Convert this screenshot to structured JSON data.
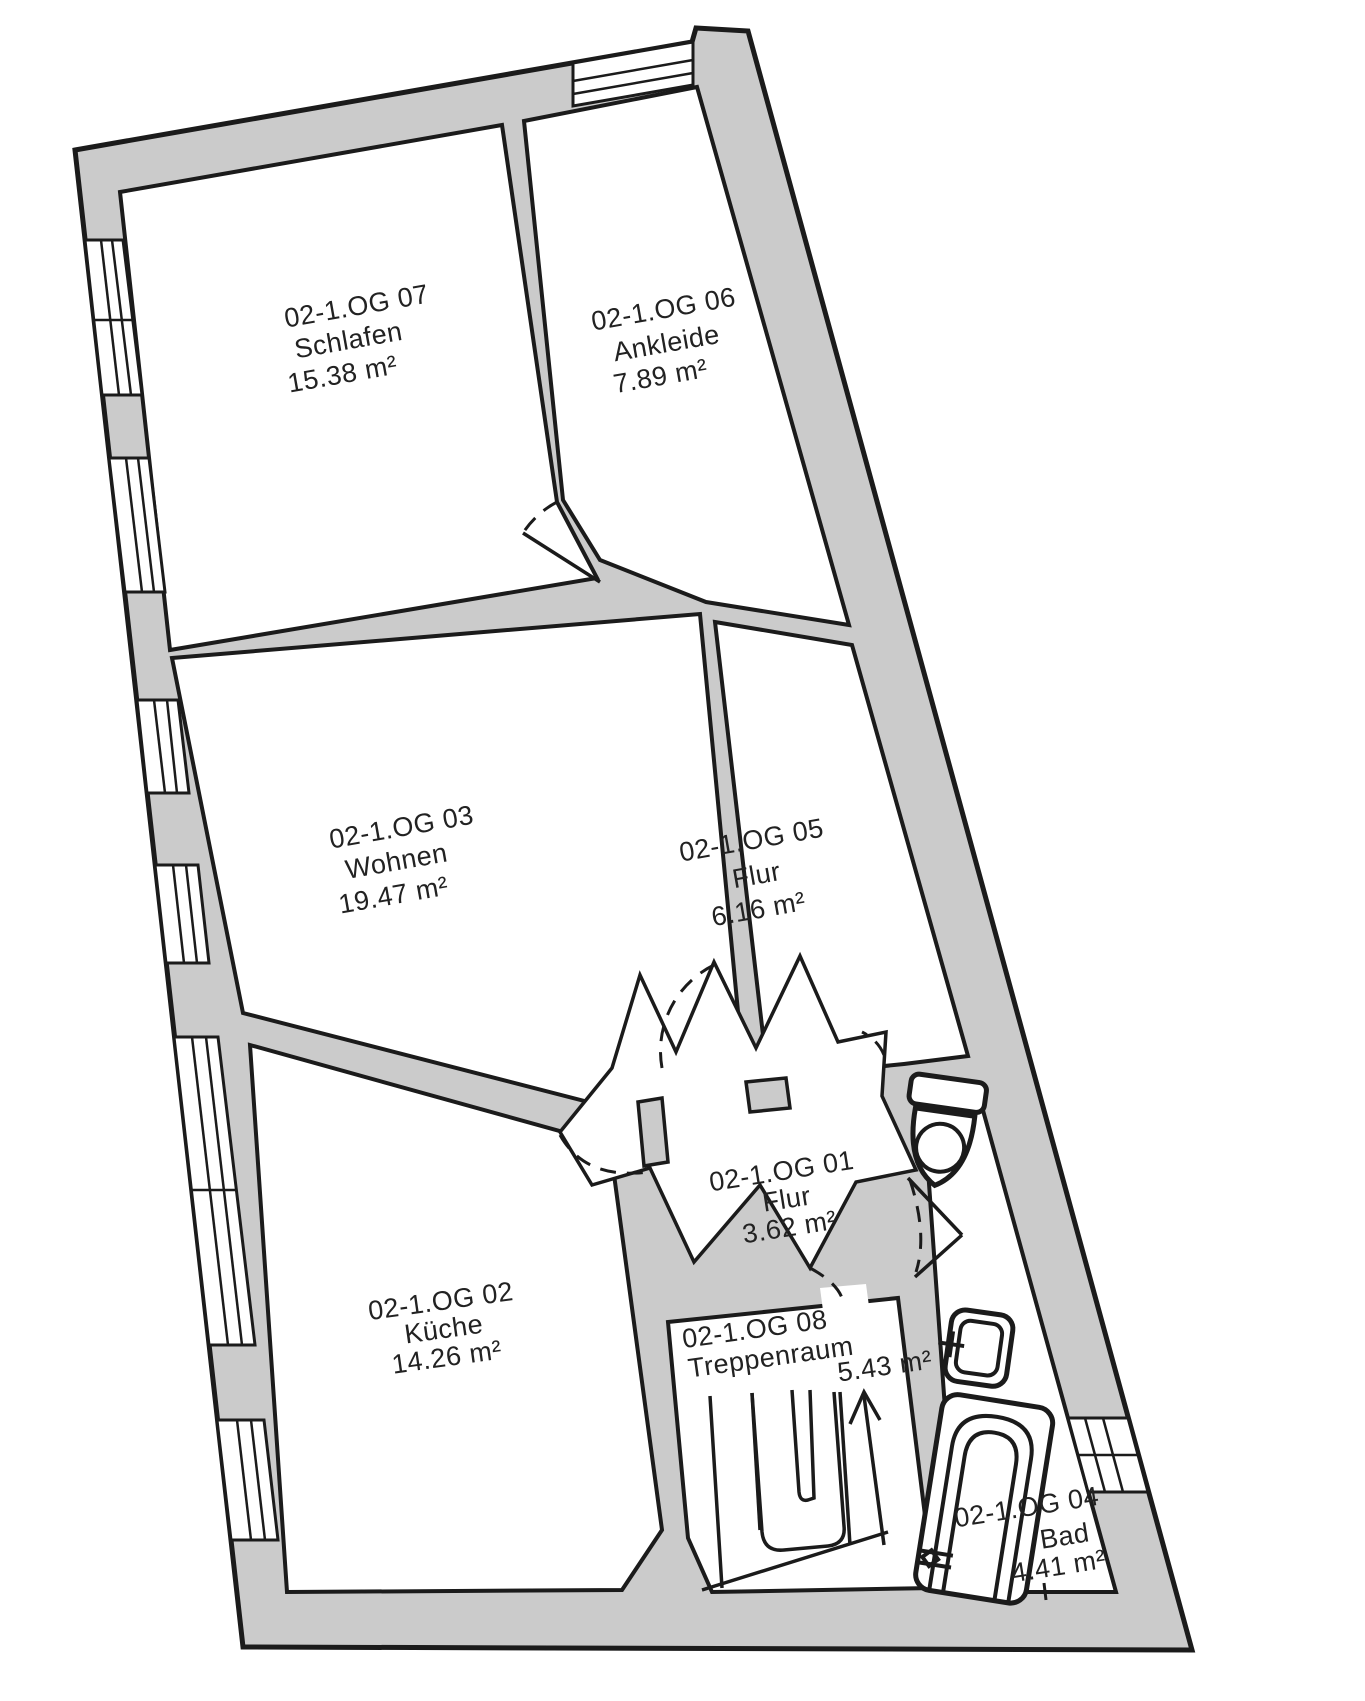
{
  "document": {
    "type": "apartment-floor-plan",
    "floor": "1.OG"
  },
  "colors": {
    "wall_fill": "#cbcbcb",
    "line": "#1b1b1b",
    "background": "#ffffff",
    "text": "#222222"
  },
  "rooms": [
    {
      "code": "02-1.OG 07",
      "name": "Schlafen",
      "area": "15.38 m²"
    },
    {
      "code": "02-1.OG 06",
      "name": "Ankleide",
      "area": "7.89 m²"
    },
    {
      "code": "02-1.OG 03",
      "name": "Wohnen",
      "area": "19.47 m²"
    },
    {
      "code": "02-1.OG 05",
      "name": "Flur",
      "area": "6.16 m²"
    },
    {
      "code": "02-1.OG 01",
      "name": "Flur",
      "area": "3.62 m²"
    },
    {
      "code": "02-1.OG 02",
      "name": "Küche",
      "area": "14.26 m²"
    },
    {
      "code": "02-1.OG 08",
      "name": "Treppenraum",
      "area": "5.43 m²"
    },
    {
      "code": "02-1.OG 04",
      "name": "Bad",
      "area": "4.41 m²"
    }
  ],
  "fixtures": [
    "toilet-icon",
    "washbasin-icon",
    "bathtub-icon",
    "stairs-icon",
    "stairs-up-arrow"
  ]
}
